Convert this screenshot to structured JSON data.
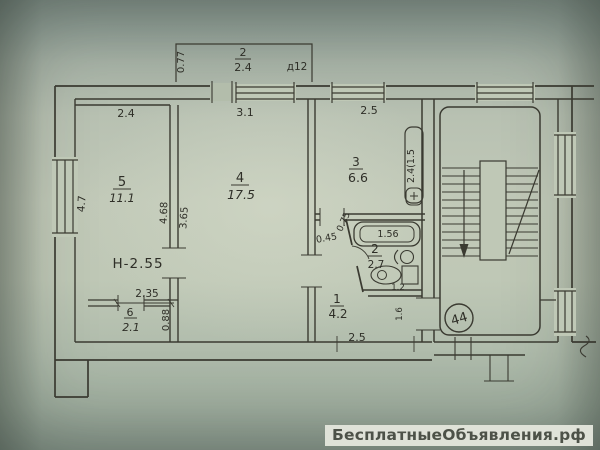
{
  "colors": {
    "paper": "#bcc5b4",
    "ink": "#35352d",
    "watermark_bg": "#dfe2d8",
    "watermark_text": "#4d5248"
  },
  "watermark": {
    "text": "БесплатныеОбъявления.рф"
  },
  "plan": {
    "balcony": {
      "num": "2",
      "area": "2.4",
      "depth": "0.77",
      "door_mark": "д12"
    },
    "dims": {
      "room5_top": "2.4",
      "room4_top": "3.1",
      "room3_top": "2.5",
      "left_wall": "4.7",
      "wall54_left": "4.68",
      "wall54_right": "3.65",
      "closet_top": "2.35",
      "closet_right": "0.88",
      "corridor_bottom": "2.5",
      "bath_door": "0.45",
      "room3_door": "0.75",
      "entry": "1.6",
      "vent": "2.4(1.5"
    },
    "rooms": {
      "room5": {
        "num": "5",
        "area": "11.1"
      },
      "room4": {
        "num": "4",
        "area": "17.5"
      },
      "room3": {
        "num": "3",
        "area": "6.6"
      },
      "closet": {
        "num": "6",
        "area": "2.1"
      },
      "corridor": {
        "num": "1",
        "area": "4.2"
      },
      "bath": {
        "num": "2",
        "area": "2.7"
      }
    },
    "fixtures": {
      "tub": "1.56",
      "toilet": "1.2"
    },
    "height_note": "Н-2.55",
    "apartment_number": "44"
  }
}
